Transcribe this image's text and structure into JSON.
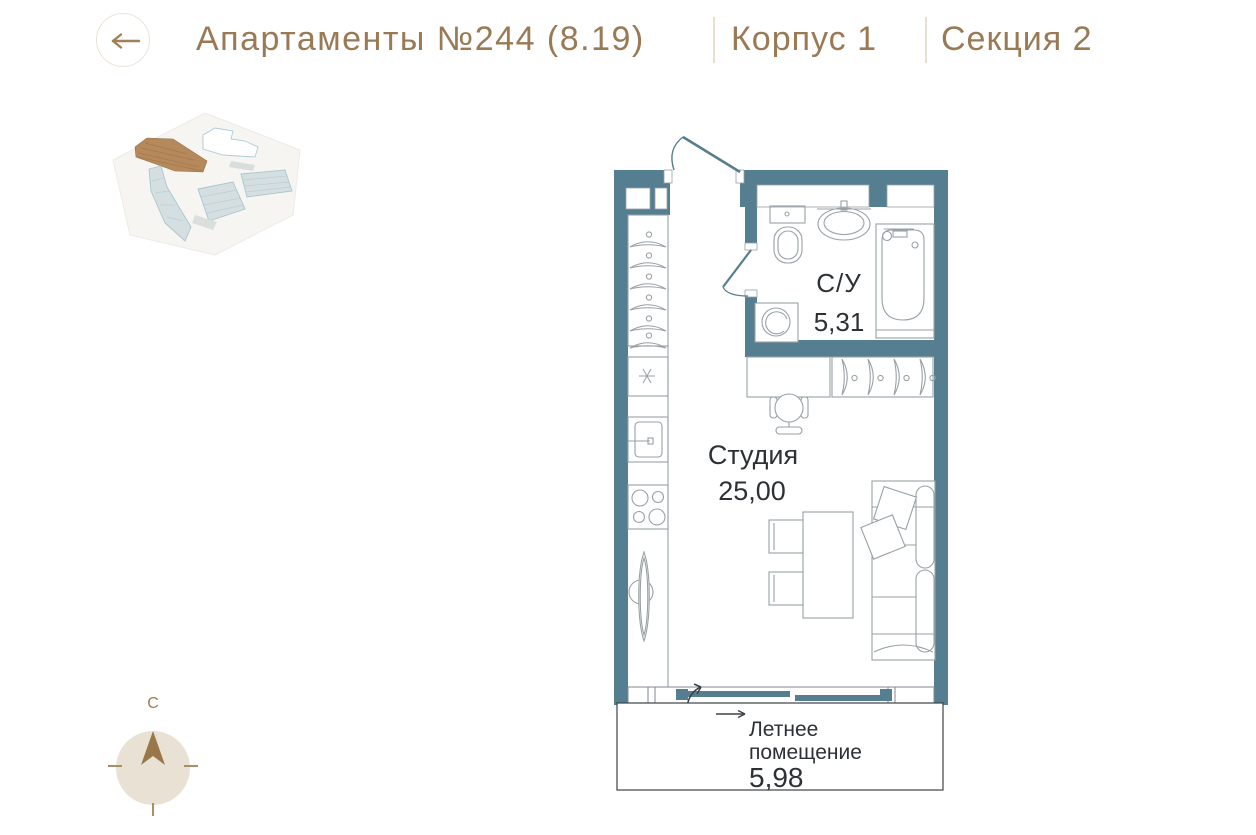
{
  "header": {
    "title": "Апартаменты №244 (8.19)",
    "building": "Корпус 1",
    "section": "Секция 2",
    "icons": {
      "back": "arrow-left"
    }
  },
  "floor_plan": {
    "rooms": {
      "bathroom": {
        "label": "С/У",
        "area": "5,31"
      },
      "studio": {
        "label": "Студия",
        "area": "25,00"
      },
      "summer_room": {
        "label_line1": "Летнее",
        "label_line2": "помещение",
        "area": "5,98"
      }
    }
  },
  "compass": {
    "north_label": "С",
    "icon": "north-arrow"
  },
  "minimap": {
    "icon": "site-plan",
    "selected_building_color": "#b5895b",
    "building_color": "#d5dfe1"
  },
  "colors": {
    "accent_brown": "#997a55",
    "wall_teal": "#557f90",
    "plan_text": "#2d3135",
    "furniture_line": "#98a1a6",
    "compass_fill": "#e9e1d3"
  }
}
